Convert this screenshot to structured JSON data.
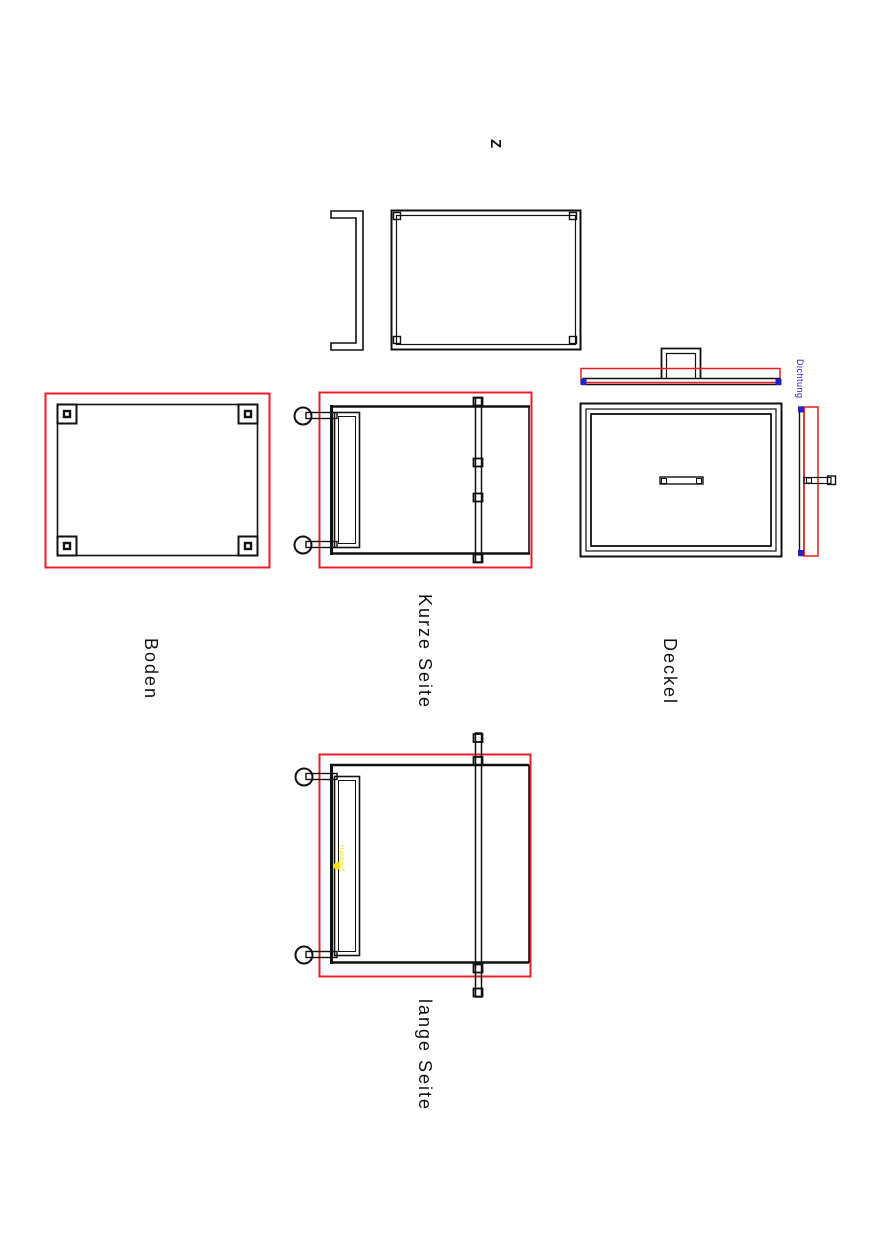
{
  "drawing": {
    "compass_letter": "Z",
    "views": {
      "boden": {
        "label": "Boden"
      },
      "kurze_seite": {
        "label": "Kurze Seite"
      },
      "deckel": {
        "label": "Deckel",
        "seal_annotation": "Dichtung"
      },
      "lange_seite": {
        "label": "lange Seite",
        "yellow_annotation": "Handgriff"
      }
    }
  },
  "colors": {
    "outline": "#111111",
    "highlight_red": "#ed1c24",
    "seal_blue": "#2222cc",
    "annotation_yellow": "#f2e400"
  }
}
